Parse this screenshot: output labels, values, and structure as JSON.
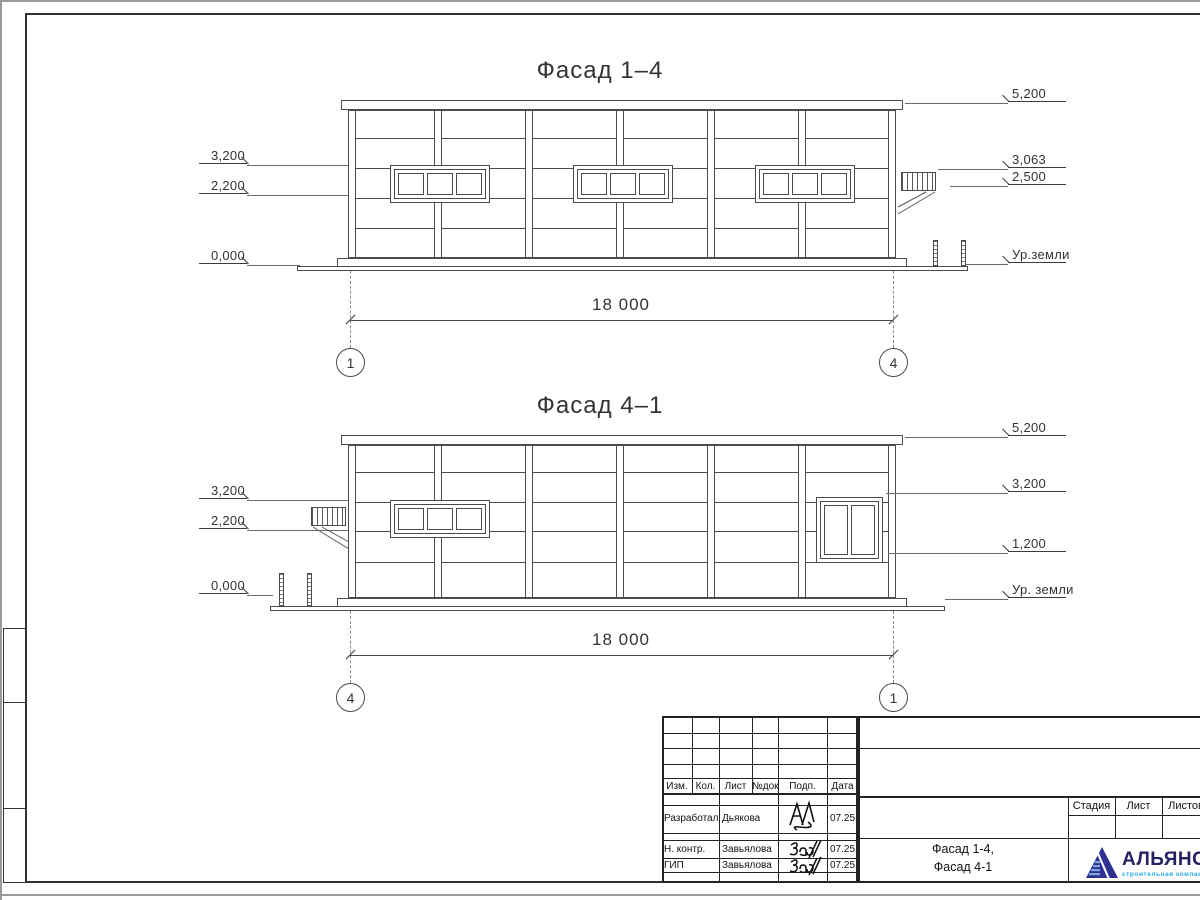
{
  "facades": [
    {
      "title": "Фасад 1–4",
      "marks_left": [
        {
          "label": "3,200"
        },
        {
          "label": "2,200"
        },
        {
          "label": "0,000"
        }
      ],
      "marks_right": [
        {
          "label": "5,200"
        },
        {
          "label": "3,063"
        },
        {
          "label": "2,500"
        },
        {
          "label": "Ур.земли"
        }
      ],
      "dimension": "18 000",
      "axis_left": "1",
      "axis_right": "4"
    },
    {
      "title": "Фасад 4–1",
      "marks_left": [
        {
          "label": "3,200"
        },
        {
          "label": "2,200"
        },
        {
          "label": "0,000"
        }
      ],
      "marks_right": [
        {
          "label": "5,200"
        },
        {
          "label": "3,200"
        },
        {
          "label": "1,200"
        },
        {
          "label": "Ур. земли"
        }
      ],
      "dimension": "18 000",
      "axis_left": "4",
      "axis_right": "1"
    }
  ],
  "title_block": {
    "revision_headers": [
      "Изм.",
      "Кол.",
      "Лист",
      "№док",
      "Подп.",
      "Дата"
    ],
    "rows": [
      {
        "role": "Разработал",
        "name": "Дьякова",
        "date": "07.25"
      },
      {
        "role": "Н. контр.",
        "name": "Завьялова",
        "date": "07.25"
      },
      {
        "role": "ГИП",
        "name": "Завьялова",
        "date": "07.25"
      }
    ],
    "doc_title_line1": "Фасад 1-4,",
    "doc_title_line2": "Фасад 4-1",
    "stage_headers": [
      "Стадия",
      "Лист",
      "Листов"
    ],
    "logo": {
      "name": "АЛЬЯНС",
      "subtitle": "строительная компания",
      "accent": "#2e3192",
      "subtitle_color": "#29abe2"
    }
  }
}
